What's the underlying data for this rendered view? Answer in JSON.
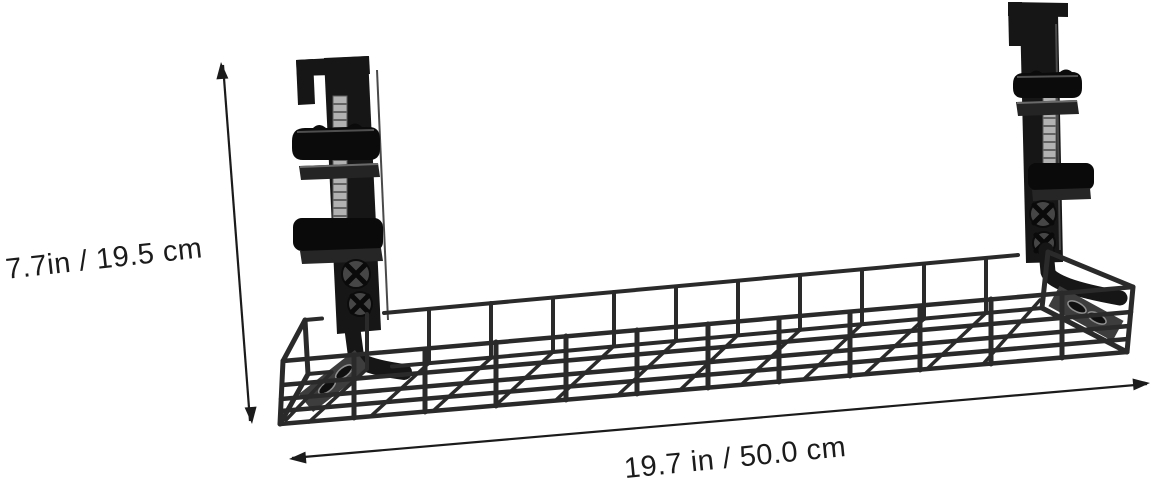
{
  "page": {
    "background": "#ffffff",
    "kind": "product-photo"
  },
  "product": {
    "name": "Under-desk cable management wire tray with two desk clamps",
    "black": "#161616",
    "wire_color": "#2a2a2a",
    "metal_gray": "#b2b2b2",
    "plate_gray": "#3d3d3d"
  },
  "annotations": {
    "color": "#1b1b1b",
    "height_label": "7.7in / 19.5 cm",
    "width_label": "19.7 in / 50.0 cm"
  }
}
